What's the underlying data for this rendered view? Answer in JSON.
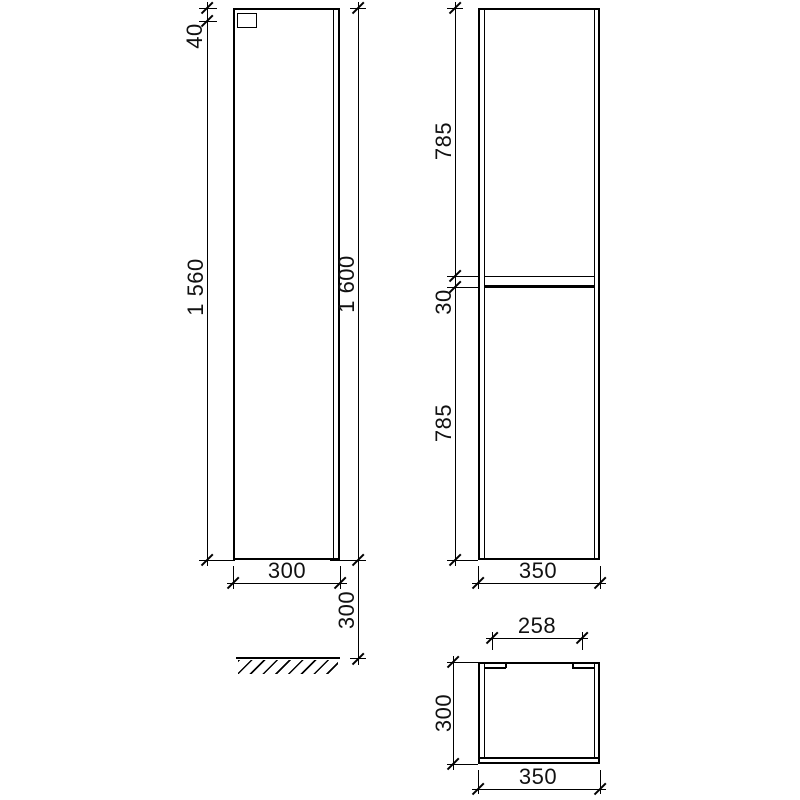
{
  "drawing": {
    "type": "technical-dimension-drawing",
    "subject": "tall-cabinet-three-views",
    "colors": {
      "line": "#000000",
      "text": "#111111",
      "background": "#ffffff"
    },
    "dims": {
      "side_bracket_offset": "40",
      "side_body_height": "1 560",
      "side_total_height": "1 600",
      "side_depth": "300",
      "side_floor_clearance": "300",
      "front_upper_door": "785",
      "front_center_gap": "30",
      "front_lower_door": "785",
      "front_width": "350",
      "top_inner_width": "258",
      "top_depth": "300",
      "top_width": "350"
    }
  }
}
